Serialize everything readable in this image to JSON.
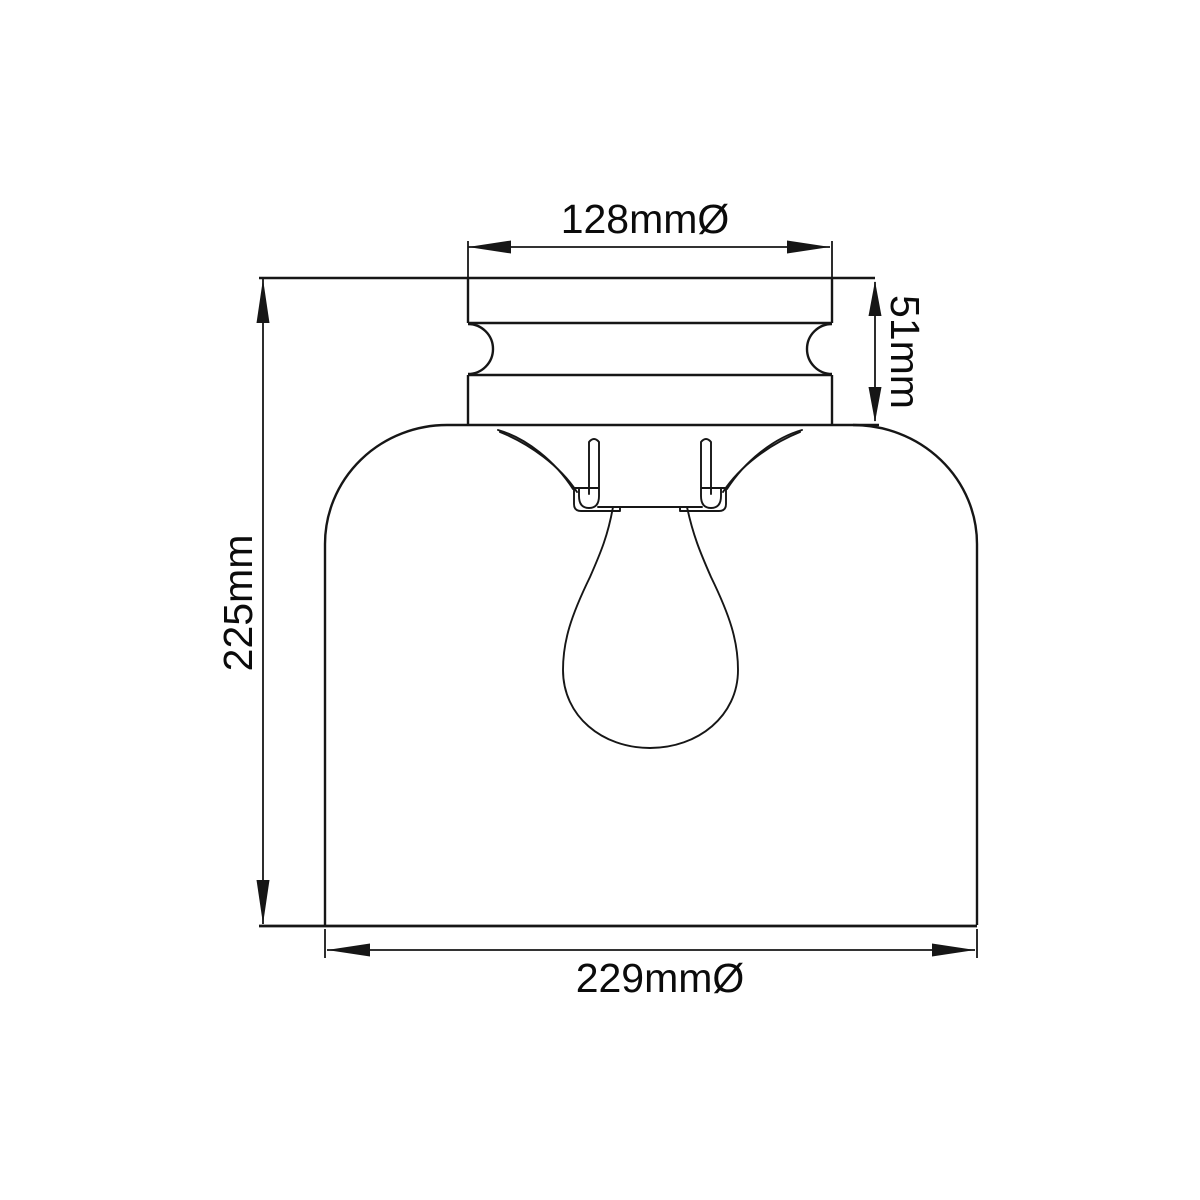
{
  "page": {
    "background": "#ffffff",
    "line_color": "#161616",
    "text_color": "#0b0b0b"
  },
  "drawing": {
    "kind": "technical-dimension-diagram",
    "subject": "ceiling light glass dome shade with fitter, lamp holder and bulb"
  },
  "dimensions": {
    "top_width": {
      "label": "128mmØ",
      "value": 128,
      "unit": "mm",
      "diameter": true,
      "orientation": "horizontal",
      "measures": "fitter outer diameter"
    },
    "fitter_height": {
      "label": "51mm",
      "value": 51,
      "unit": "mm",
      "diameter": false,
      "orientation": "vertical",
      "measures": "fitter height"
    },
    "overall_height": {
      "label": "225mm",
      "value": 225,
      "unit": "mm",
      "diameter": false,
      "orientation": "vertical",
      "measures": "overall height"
    },
    "shade_width": {
      "label": "229mmØ",
      "value": 229,
      "unit": "mm",
      "diameter": true,
      "orientation": "horizontal",
      "measures": "shade outer diameter"
    }
  }
}
